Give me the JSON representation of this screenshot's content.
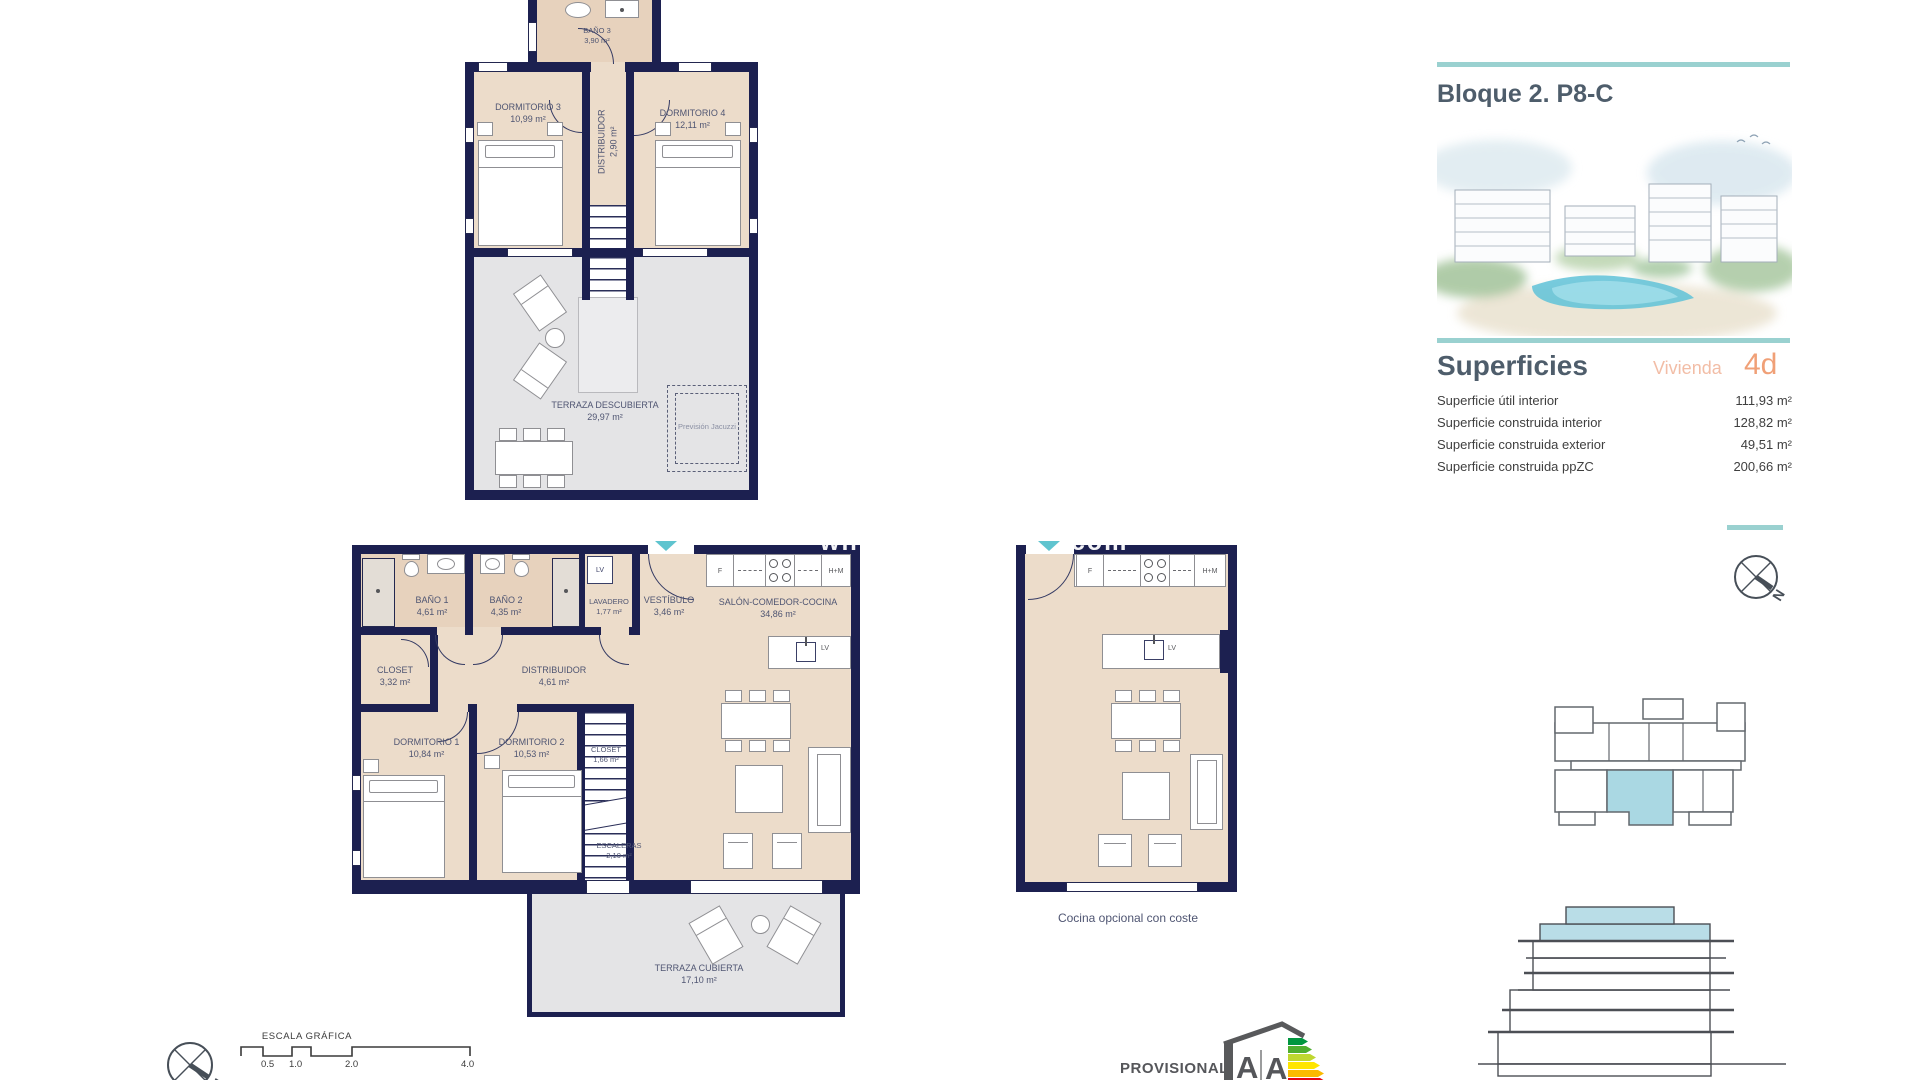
{
  "watermark": {
    "part1": "whit",
    "part2": ".com"
  },
  "plans": {
    "upper": {
      "rooms": {
        "bano3": {
          "name": "BAÑO 3",
          "area": "3,90 m²"
        },
        "dorm3": {
          "name": "DORMITORIO 3",
          "area": "10,99 m²"
        },
        "dorm4": {
          "name": "DORMITORIO 4",
          "area": "12,11 m²"
        },
        "dist": {
          "name": "DISTRIBUIDOR",
          "area": "2,90 m²"
        },
        "terraza": {
          "name": "TERRAZA DESCUBIERTA",
          "area": "29,97 m²"
        },
        "jacuzzi": {
          "name": "Previsión Jacuzzi"
        }
      }
    },
    "main": {
      "rooms": {
        "bano1": {
          "name": "BAÑO 1",
          "area": "4,61 m²"
        },
        "bano2": {
          "name": "BAÑO 2",
          "area": "4,35 m²"
        },
        "lavadero": {
          "name": "LAVADERO",
          "area": "1,77 m²"
        },
        "vestibulo": {
          "name": "VESTÍBULO",
          "area": "3,46 m²"
        },
        "salon": {
          "name": "SALÓN-COMEDOR-COCINA",
          "area": "34,86 m²"
        },
        "closet1": {
          "name": "CLOSET",
          "area": "3,32 m²"
        },
        "dist": {
          "name": "DISTRIBUIDOR",
          "area": "4,61 m²"
        },
        "dorm1": {
          "name": "DORMITORIO 1",
          "area": "10,84 m²"
        },
        "dorm2": {
          "name": "DORMITORIO 2",
          "area": "10,53 m²"
        },
        "closet2": {
          "name": "CLOSET",
          "area": "1,66 m²"
        },
        "escaleras": {
          "name": "ESCALERAS",
          "area": "2,10 m²"
        },
        "terraza": {
          "name": "TERRAZA CUBIERTA",
          "area": "17,10 m²"
        }
      },
      "appliances": {
        "f": "F",
        "hm": "H+M",
        "lv_laundry": "LV",
        "lv_island": "LV"
      }
    },
    "optional": {
      "caption": "Cocina opcional con coste",
      "appliances": {
        "f": "F",
        "hm": "H+M",
        "lv_island": "LV"
      }
    }
  },
  "sidebar": {
    "title": "Bloque 2. P8-C",
    "superficies": {
      "heading": "Superficies",
      "vivienda_label": "Vivienda",
      "vivienda_code": "4d",
      "rows": [
        {
          "label": "Superficie útil interior",
          "value": "111,93 m²"
        },
        {
          "label": "Superficie construida interior",
          "value": "128,82 m²"
        },
        {
          "label": "Superficie construida exterior",
          "value": "49,51 m²"
        },
        {
          "label": "Superficie construida ppZC",
          "value": "200,66 m²"
        }
      ]
    },
    "compass_label": "N"
  },
  "footer": {
    "scale_title": "ESCALA GRÁFICA",
    "scale_ticks": [
      "0.5",
      "1.0",
      "2.0",
      "4.0"
    ],
    "provisional": "PROVISIONAL",
    "compass_label": "N",
    "energy": {
      "letter1": "A",
      "letter2": "A"
    }
  },
  "colors": {
    "wall": "#1c2050",
    "floor": "#ecdcca",
    "terrace": "#e4e4e6",
    "accent_teal": "#9ad1d0",
    "accent_salmon": "#f0a077",
    "unit_highlight": "#aad8e3"
  }
}
